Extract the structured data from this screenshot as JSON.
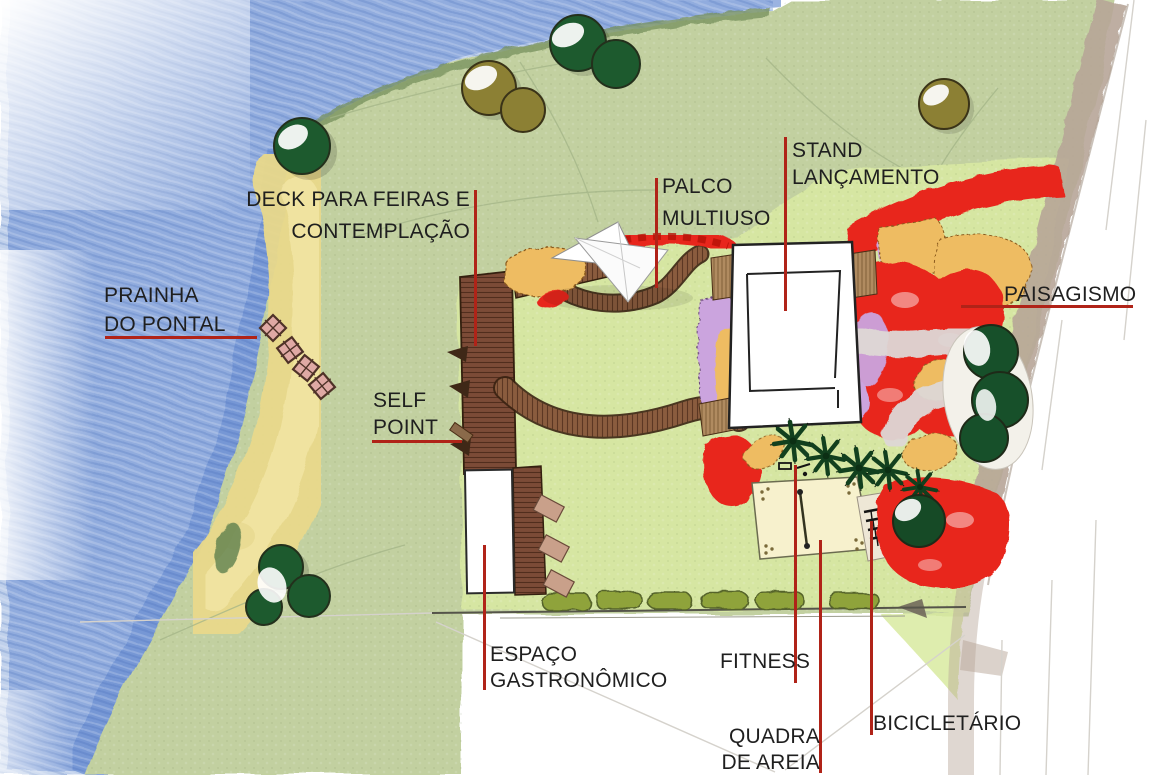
{
  "canvas": {
    "width": 1150,
    "height": 775
  },
  "annotations": {
    "prainha_do_pontal": {
      "lines": [
        "PRAINHA",
        "DO PONTAL"
      ]
    },
    "deck_feiras": {
      "lines": [
        "DECK PARA FEIRAS E",
        "CONTEMPLAÇÃO"
      ]
    },
    "self_point": {
      "lines": [
        "SELF",
        "POINT"
      ]
    },
    "palco_multiuso": {
      "lines": [
        "PALCO",
        "MULTIUSO"
      ]
    },
    "stand_lancamento": {
      "lines": [
        "STAND",
        "LANÇAMENTO"
      ]
    },
    "paisagismo": {
      "lines": [
        "PAISAGISMO"
      ]
    },
    "espaco_gastronomico": {
      "lines": [
        "ESPAÇO",
        "GASTRONÔMICO"
      ]
    },
    "fitness": {
      "lines": [
        "FITNESS"
      ]
    },
    "quadra_de_areia": {
      "lines": [
        "QUADRA",
        "DE AREIA"
      ]
    },
    "bicicletario": {
      "lines": [
        "BICICLETÁRIO"
      ]
    }
  },
  "features": [
    "lake-water",
    "beach-sand",
    "grass-field",
    "event-lawn",
    "wood-deck",
    "boardwalk",
    "stage-canopy",
    "stand-building",
    "gastronomy-building",
    "sand-court",
    "bike-racks",
    "fitness-equipment",
    "hedge-row",
    "road",
    "flower-beds-red-orange-purple",
    "palm-trees",
    "round-trees",
    "stone-pavers"
  ],
  "colors": {
    "label_text": "#1f1f1f",
    "leader_line": "#b02318",
    "water_blue": "#8aa6dc",
    "sand_yellow": "#e9d98b",
    "grass_green": "#c2d0a0",
    "lawn_green": "#d7e7a3",
    "deck_wood_brown": "#7c4b37",
    "boardwalk_brown": "#8a5c3e",
    "flower_red": "#e8251c",
    "flower_orange": "#eebc62",
    "flower_purple": "#cba4de",
    "hedge_olive": "#8fa33b",
    "tree_dark_green": "#1d5a2e",
    "tree_olive": "#8c8034",
    "road_tan": "#b7a698",
    "court_cream": "#f7f1cd"
  }
}
